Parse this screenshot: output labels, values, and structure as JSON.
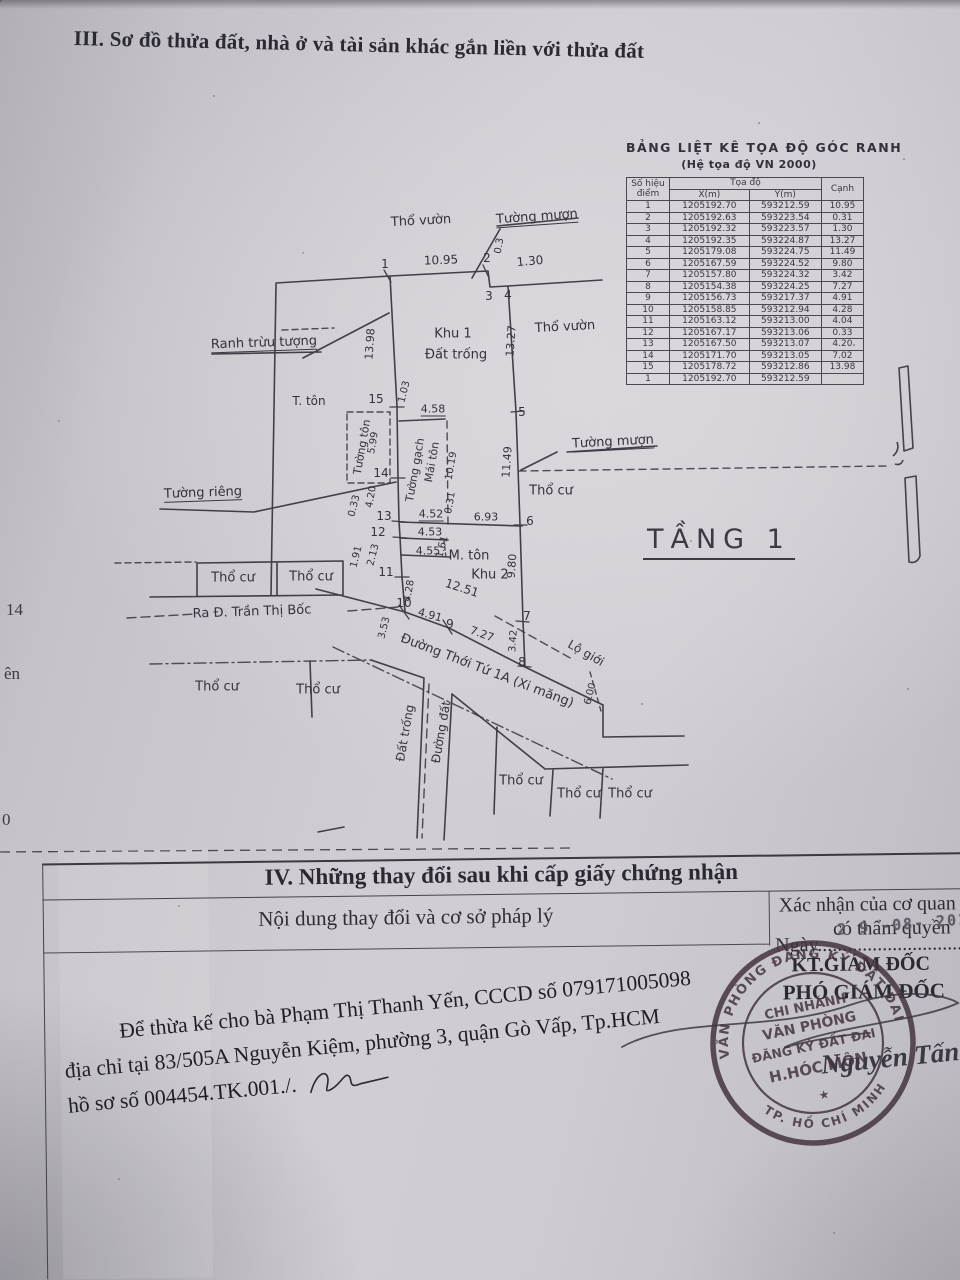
{
  "page": {
    "section3_title": "III. Sơ đồ thửa đất, nhà ở và tài sản khác gắn liền với thửa đất",
    "margin_artifacts": [
      {
        "t": "14",
        "x": 6,
        "y": 600
      },
      {
        "t": "ên",
        "x": 4,
        "y": 664
      },
      {
        "t": "0",
        "x": 2,
        "y": 810
      }
    ]
  },
  "coords_table": {
    "title": "BẢNG LIỆT KÊ TỌA ĐỘ GÓC RANH",
    "subtitle": "(Hệ tọa độ VN 2000)",
    "col_point": "Số hiệu điểm",
    "col_coords": "Tọa độ",
    "col_x": "X(m)",
    "col_y": "Y(m)",
    "col_edge": "Cạnh",
    "rows": [
      [
        "1",
        "1205192.70",
        "593212.59",
        "10.95"
      ],
      [
        "2",
        "1205192.63",
        "593223.54",
        "0.31"
      ],
      [
        "3",
        "1205192.32",
        "593223.57",
        "1.30"
      ],
      [
        "4",
        "1205192.35",
        "593224.87",
        "13.27"
      ],
      [
        "5",
        "1205179.08",
        "593224.75",
        "11.49"
      ],
      [
        "6",
        "1205167.59",
        "593224.52",
        "9.80"
      ],
      [
        "7",
        "1205157.80",
        "593224.32",
        "3.42"
      ],
      [
        "8",
        "1205154.38",
        "593224.25",
        "7.27"
      ],
      [
        "9",
        "1205156.73",
        "593217.37",
        "4.91"
      ],
      [
        "10",
        "1205158.85",
        "593212.94",
        "4.28"
      ],
      [
        "11",
        "1205163.12",
        "593213.00",
        "4.04"
      ],
      [
        "12",
        "1205167.17",
        "593213.06",
        "0.33"
      ],
      [
        "13",
        "1205167.50",
        "593213.07",
        "4.20"
      ],
      [
        "14",
        "1205171.70",
        "593213.05",
        "7.02"
      ],
      [
        "15",
        "1205178.72",
        "593212.86",
        "13.98"
      ],
      [
        "1",
        "1205192.70",
        "593212.59",
        ""
      ]
    ]
  },
  "diagram": {
    "floor_label": "TẦNG 1",
    "labels": [
      {
        "t": "Thổ vườn",
        "x": 421,
        "y": 221,
        "r": -3,
        "s": 13
      },
      {
        "t": "Tường mượn",
        "x": 537,
        "y": 218,
        "r": -4,
        "s": 13,
        "u": 1
      },
      {
        "t": "1",
        "x": 385,
        "y": 264,
        "s": 12
      },
      {
        "t": "10.95",
        "x": 441,
        "y": 260,
        "r": -2,
        "s": 12
      },
      {
        "t": "2",
        "x": 487,
        "y": 258,
        "s": 12
      },
      {
        "t": "0.3",
        "x": 500,
        "y": 246,
        "r": -80,
        "s": 10
      },
      {
        "t": "1.30",
        "x": 530,
        "y": 261,
        "r": -5,
        "s": 12
      },
      {
        "t": "3",
        "x": 489,
        "y": 296,
        "s": 12
      },
      {
        "t": "4",
        "x": 508,
        "y": 295,
        "s": 12
      },
      {
        "t": "Ranh trừu tượng",
        "x": 264,
        "y": 344,
        "r": -2,
        "s": 13,
        "u": 1
      },
      {
        "t": "13.98",
        "x": 370,
        "y": 344,
        "r": -86,
        "s": 11
      },
      {
        "t": "Khu 1",
        "x": 453,
        "y": 334,
        "s": 13
      },
      {
        "t": "Đất trống",
        "x": 456,
        "y": 355,
        "s": 13
      },
      {
        "t": "13.27",
        "x": 511,
        "y": 341,
        "r": -86,
        "s": 11
      },
      {
        "t": "Thổ vườn",
        "x": 565,
        "y": 327,
        "r": -3,
        "s": 13
      },
      {
        "t": "T. tôn",
        "x": 309,
        "y": 401,
        "s": 12
      },
      {
        "t": "15",
        "x": 376,
        "y": 399,
        "s": 12
      },
      {
        "t": "1.03",
        "x": 405,
        "y": 392,
        "r": -76,
        "s": 10
      },
      {
        "t": "4.58",
        "x": 433,
        "y": 410,
        "s": 11,
        "u": 1
      },
      {
        "t": "5",
        "x": 522,
        "y": 412,
        "s": 12
      },
      {
        "t": "Tường tôn",
        "x": 362,
        "y": 447,
        "r": -80,
        "s": 11
      },
      {
        "t": "5.99",
        "x": 374,
        "y": 443,
        "r": -80,
        "s": 10
      },
      {
        "t": "Tường gạch",
        "x": 415,
        "y": 470,
        "r": -80,
        "s": 11
      },
      {
        "t": "Mái tôn",
        "x": 432,
        "y": 462,
        "r": -80,
        "s": 11
      },
      {
        "t": "10.19",
        "x": 452,
        "y": 466,
        "r": -80,
        "s": 10
      },
      {
        "t": "11.49",
        "x": 507,
        "y": 462,
        "r": -86,
        "s": 11
      },
      {
        "t": "Tường mượn",
        "x": 613,
        "y": 443,
        "r": -3,
        "s": 13,
        "u": 1
      },
      {
        "t": "14",
        "x": 381,
        "y": 473,
        "s": 12
      },
      {
        "t": "Tường riêng",
        "x": 203,
        "y": 494,
        "r": -2,
        "s": 13,
        "u": 1
      },
      {
        "t": "4.20",
        "x": 372,
        "y": 497,
        "r": -80,
        "s": 10
      },
      {
        "t": "0.33",
        "x": 355,
        "y": 506,
        "r": -76,
        "s": 10
      },
      {
        "t": "Thổ cư",
        "x": 551,
        "y": 491,
        "s": 13
      },
      {
        "t": "13",
        "x": 384,
        "y": 516,
        "s": 12
      },
      {
        "t": "4.52",
        "x": 431,
        "y": 515,
        "s": 11,
        "u": 1
      },
      {
        "t": "0.31",
        "x": 451,
        "y": 503,
        "r": -80,
        "s": 10
      },
      {
        "t": "6.93",
        "x": 486,
        "y": 517,
        "s": 11
      },
      {
        "t": "6",
        "x": 530,
        "y": 521,
        "s": 12
      },
      {
        "t": "12",
        "x": 378,
        "y": 532,
        "s": 12
      },
      {
        "t": "4.53",
        "x": 430,
        "y": 532,
        "s": 11
      },
      {
        "t": "1.91",
        "x": 357,
        "y": 557,
        "r": -76,
        "s": 10
      },
      {
        "t": "2.13",
        "x": 374,
        "y": 555,
        "r": -76,
        "s": 10
      },
      {
        "t": "1.61",
        "x": 443,
        "y": 547,
        "r": -76,
        "s": 10
      },
      {
        "t": "4.55",
        "x": 428,
        "y": 551,
        "s": 11
      },
      {
        "t": "M. tôn",
        "x": 469,
        "y": 556,
        "s": 13
      },
      {
        "t": "9.80",
        "x": 512,
        "y": 566,
        "r": -86,
        "s": 11
      },
      {
        "t": "11",
        "x": 386,
        "y": 572,
        "s": 12
      },
      {
        "t": "Khu 2",
        "x": 490,
        "y": 575,
        "s": 13
      },
      {
        "t": "Thổ cư",
        "x": 233,
        "y": 578,
        "s": 13
      },
      {
        "t": "Thổ cư",
        "x": 311,
        "y": 577,
        "s": 13
      },
      {
        "t": "4.28",
        "x": 410,
        "y": 591,
        "r": -80,
        "s": 10
      },
      {
        "t": "12.51",
        "x": 462,
        "y": 588,
        "r": 18,
        "s": 12
      },
      {
        "t": "Ra Đ. Trần Thị Bốc",
        "x": 252,
        "y": 612,
        "r": -2,
        "s": 13
      },
      {
        "t": "10",
        "x": 404,
        "y": 603,
        "s": 12
      },
      {
        "t": "4.91",
        "x": 430,
        "y": 615,
        "r": 16,
        "s": 11
      },
      {
        "t": "9",
        "x": 450,
        "y": 624,
        "s": 12
      },
      {
        "t": "7.27",
        "x": 482,
        "y": 634,
        "r": 20,
        "s": 11
      },
      {
        "t": "7",
        "x": 527,
        "y": 616,
        "s": 12
      },
      {
        "t": "3.42",
        "x": 514,
        "y": 641,
        "r": -86,
        "s": 10
      },
      {
        "t": "3.53",
        "x": 385,
        "y": 628,
        "r": -76,
        "s": 10
      },
      {
        "t": "Lộ giới",
        "x": 586,
        "y": 653,
        "r": 30,
        "s": 12
      },
      {
        "t": "8",
        "x": 522,
        "y": 662,
        "s": 12
      },
      {
        "t": "Đường Thới Tứ 1A (Xi măng)",
        "x": 487,
        "y": 671,
        "r": 21,
        "s": 13
      },
      {
        "t": "6.00",
        "x": 591,
        "y": 694,
        "r": -76,
        "s": 10
      },
      {
        "t": "Thổ cư",
        "x": 217,
        "y": 687,
        "s": 13
      },
      {
        "t": "Thổ cư",
        "x": 318,
        "y": 690,
        "s": 13
      },
      {
        "t": "Đất trống",
        "x": 405,
        "y": 733,
        "r": -80,
        "s": 12
      },
      {
        "t": "Đường đất",
        "x": 441,
        "y": 732,
        "r": -80,
        "s": 12
      },
      {
        "t": "Thổ cư",
        "x": 521,
        "y": 781,
        "s": 13
      },
      {
        "t": "Thổ cư",
        "x": 579,
        "y": 794,
        "s": 13
      },
      {
        "t": "Thổ cư",
        "x": 630,
        "y": 794,
        "s": 13
      }
    ]
  },
  "section4": {
    "title": "IV. Những thay đổi sau khi cấp giấy chứng nhận",
    "col_left": "Nội dung thay đổi và cơ sở pháp lý",
    "col_right_line1": "Xác nhận của cơ quan",
    "col_right_line2": "có thẩm quyền",
    "date_label": "Ngày..............................",
    "date_stamp": "2 9 -08- 2017",
    "kt_giam_doc": "KT.GIÁM ĐỐC",
    "pho_giam_doc": "PHÓ GIÁM ĐỐC",
    "body_line1": "Để thừa kế cho bà Phạm Thị Thanh Yến, CCCD số 079171005098",
    "body_line2": "địa chỉ tại 83/505A Nguyễn Kiệm, phường 3, quận Gò Vấp, Tp.HCM",
    "body_line3": "hồ sơ số 004454.TK.001./.",
    "signature_name": "Nguyễn Tấn Ph",
    "stamp": {
      "ring_top": "VĂN PHÒNG ĐĂNG KÝ ĐẤT ĐAI",
      "ring_bottom": "TP. HỒ CHÍ MINH",
      "line1": "CHI NHÁNH",
      "line2": "VĂN PHÒNG",
      "line3": "ĐĂNG KÝ ĐẤT ĐAI",
      "line4": "H.HÓC MÔN",
      "star": "★"
    }
  }
}
